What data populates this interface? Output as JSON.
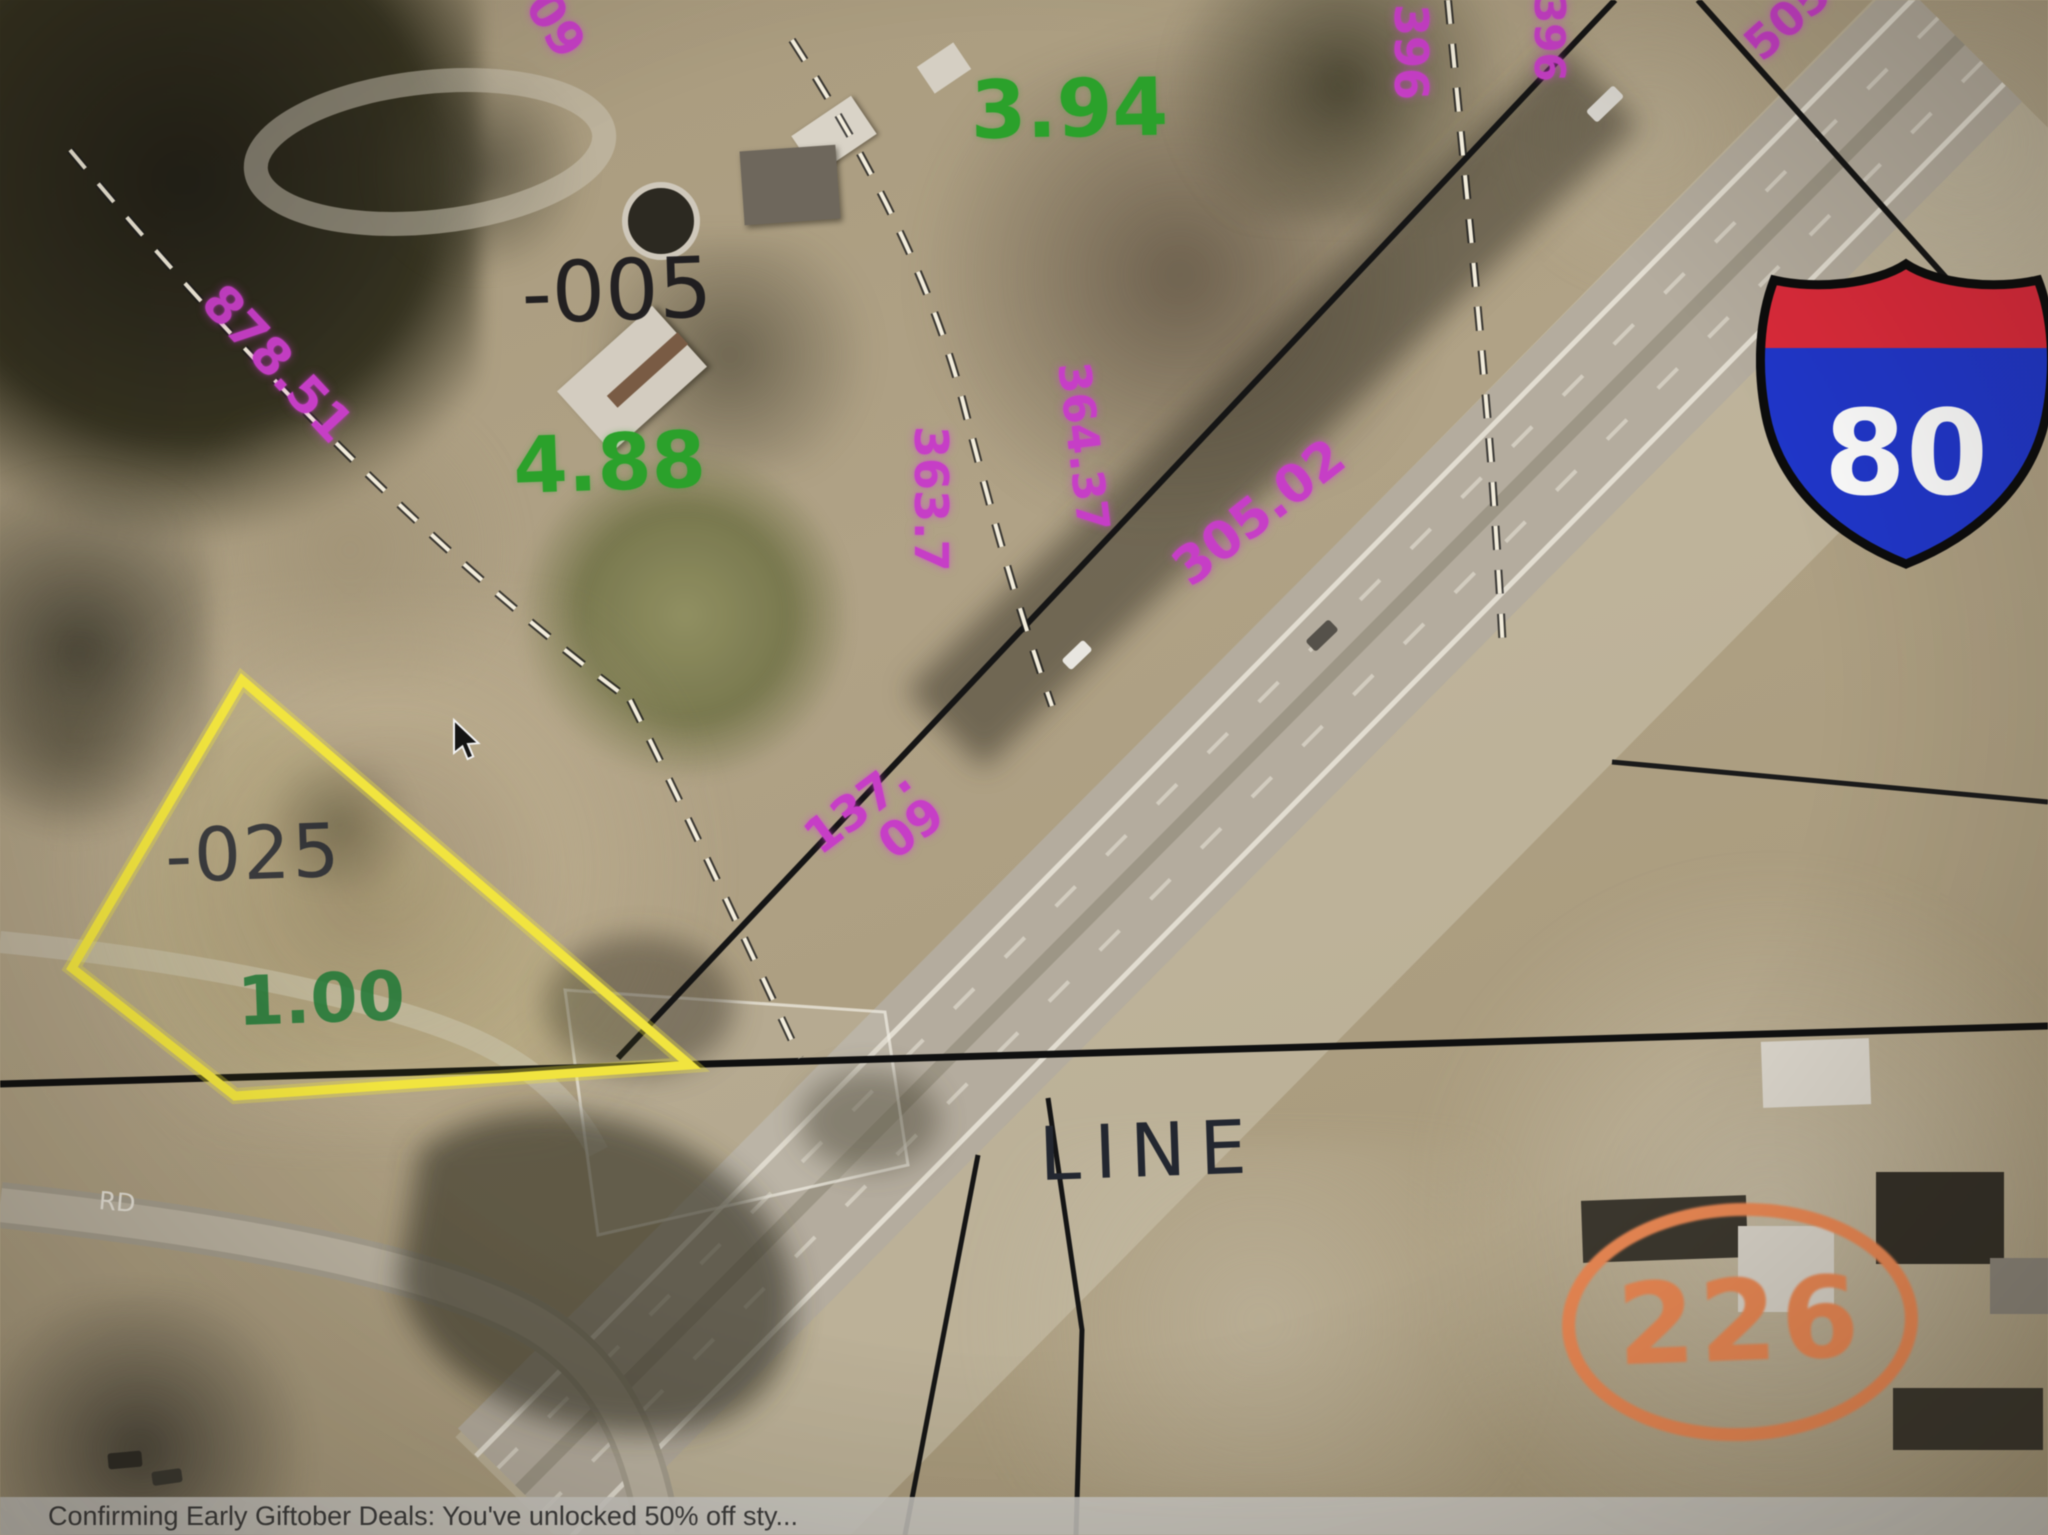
{
  "notification": {
    "text": "Confirming Early Giftober Deals: You've unlocked 50% off sty..."
  },
  "map": {
    "parcel_ids": {
      "p005": "-005",
      "p025": "-025"
    },
    "acreages": {
      "a394": "3.94",
      "a488": "4.88",
      "a100": "1.00"
    },
    "dimensions": {
      "top_partial": "09",
      "west": "878.51",
      "north_a": "396",
      "north_b": "396",
      "north_c": "505",
      "center_a": "363.7",
      "center_b": "364.37",
      "center_c": "305.02",
      "south_line1": "137.",
      "south_line2": "09"
    },
    "roads": {
      "line_label": "LINE",
      "rd_label": "RD"
    },
    "shields": {
      "interstate": "80",
      "route": "226"
    },
    "colors": {
      "dimension_magenta": "#ca3cca",
      "acreage_green": "#28a228",
      "acreage_green_dark": "#207a36",
      "parcel_text_black": "#17161a",
      "selected_parcel_yellow": "#f2e438",
      "route_orange": "#ec8650",
      "shield_red": "#e02839",
      "shield_blue": "#1e36cf"
    }
  }
}
